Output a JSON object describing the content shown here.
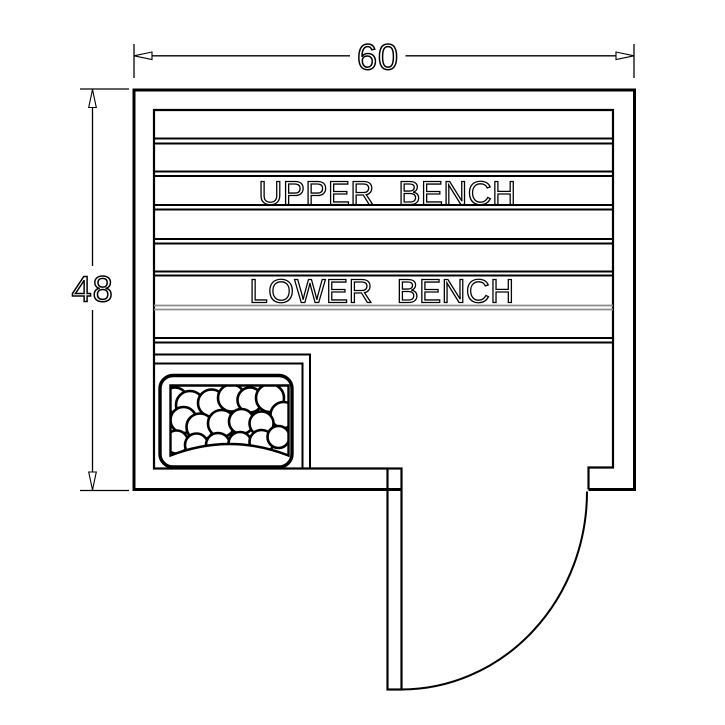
{
  "diagram": {
    "kind": "sauna-floor-plan",
    "dimension_top": "60",
    "dimension_left": "48",
    "upper_bench_label": "UPPER BENCH",
    "lower_bench_label": "LOWER BENCH",
    "colors": {
      "line": "#000000",
      "soft_line": "#8c8c8c",
      "background": "#ffffff"
    }
  }
}
